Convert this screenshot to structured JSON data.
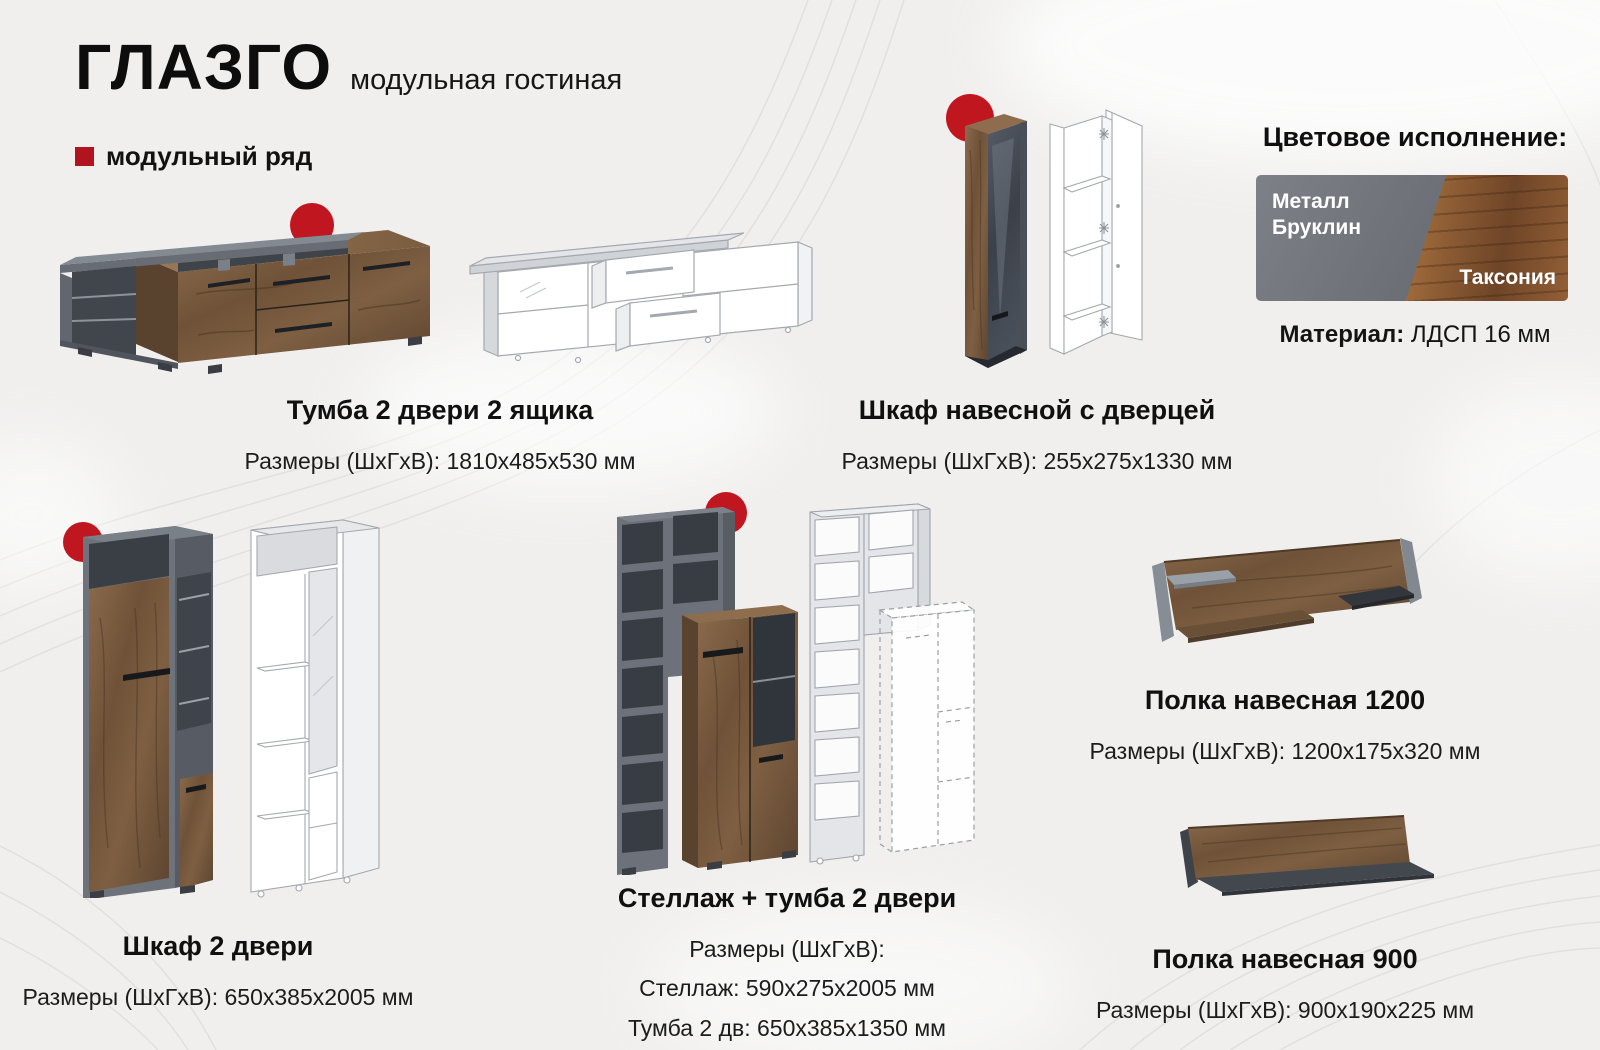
{
  "page": {
    "title": "ГЛАЗГО",
    "subtitle": "модульная гостиная",
    "series_label": "модульный ряд"
  },
  "finish": {
    "heading": "Цветовое исполнение:",
    "swatch_left": "Металл Бруклин",
    "swatch_right": "Таксония",
    "material_label": "Материал:",
    "material_value": "ЛДСП 16 мм"
  },
  "products": [
    {
      "id": "tumba",
      "name": "Тумба 2 двери 2 ящика",
      "dims": [
        "Размеры (ШхГхВ): 1810х485х530 мм"
      ]
    },
    {
      "id": "shkaf-navesnoy",
      "name": "Шкаф навесной с дверцей",
      "dims": [
        "Размеры (ШхГхВ): 255х275х1330 мм"
      ]
    },
    {
      "id": "shkaf-2-dveri",
      "name": "Шкаф 2 двери",
      "dims": [
        "Размеры (ШхГхВ): 650х385х2005 мм"
      ]
    },
    {
      "id": "stellazh-tumba",
      "name": "Стеллаж + тумба 2 двери",
      "dims": [
        "Размеры (ШхГхВ):",
        "Стеллаж: 590х275х2005 мм",
        "Тумба 2 дв: 650х385х1350 мм"
      ]
    },
    {
      "id": "polka-1200",
      "name": "Полка навесная 1200",
      "dims": [
        "Размеры (ШхГхВ): 1200х175х320 мм"
      ]
    },
    {
      "id": "polka-900",
      "name": "Полка навесная 900",
      "dims": [
        "Размеры (ШхГхВ): 900х190х225 мм"
      ]
    }
  ],
  "colors": {
    "accent_red": "#bf161f",
    "background": "#f0efee",
    "text": "#111111",
    "wood_taxonia": "#7a5a3e",
    "metal_brooklyn": "#75797f"
  }
}
